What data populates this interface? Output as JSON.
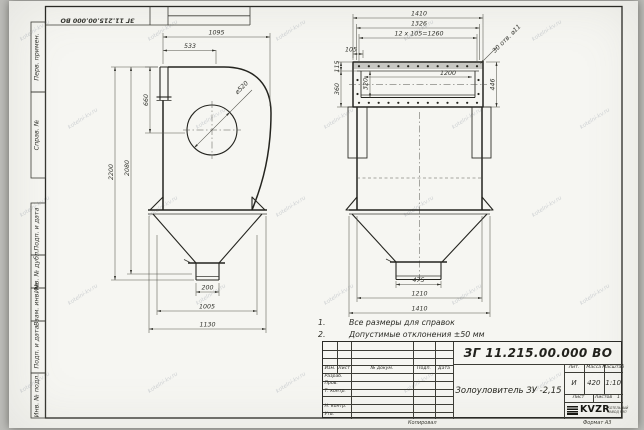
{
  "watermark": "kotelni-kv.ru",
  "frame": {
    "corner_number": "ЗГ 11.215.00.000 ВО",
    "side_labels": [
      "Перв. примен.",
      "Справ. №",
      "Подп. и дата",
      "Инв. № дубл.",
      "Взам. инв. №",
      "Подп. и дата",
      "Инв. № подл."
    ]
  },
  "notes": {
    "n1_num": "1.",
    "n1": "Все размеры для справок",
    "n2_num": "2.",
    "n2": "Допустимые отклонения  ±50 мм"
  },
  "dims": {
    "side_1095": "1095",
    "side_533": "533",
    "side_660": "660",
    "side_2200": "2200",
    "side_2080": "2080",
    "side_d520": "⌀520",
    "side_200": "200",
    "side_1005": "1005",
    "side_1130": "1130",
    "front_1410_top": "1410",
    "front_1326": "1326",
    "front_12x105": "12 х 105=1260",
    "front_105": "105",
    "front_holes": "30 отв. ⌀11",
    "front_1200": "1200",
    "front_115": "115",
    "front_360": "360",
    "front_320": "320",
    "front_446": "446",
    "front_475": "475",
    "front_1210": "1210",
    "front_1410_bot": "1410"
  },
  "title_block": {
    "doc_number": "ЗГ 11.215.00.000  ВО",
    "product_name": "Золоуловитель ЗУ -2,15",
    "col_izm": "Изм.",
    "col_list": "Лист",
    "col_doc": "№ докум.",
    "col_podp": "Подп.",
    "col_data": "Дата",
    "row_razrab": "Разраб.",
    "row_prov": "Пров.",
    "row_tkontr": "Т. контр.",
    "row_nkontr": "Н. контр.",
    "row_utv": "Утв.",
    "lit_label": "Лит.",
    "mass_label": "Масса",
    "scale_label": "Масштаб",
    "lit_value": "И",
    "mass_value": "420",
    "scale_value": "1:10",
    "sheet_label": "Лист",
    "sheets_label": "Листов",
    "sheets_value": "1",
    "logo_text": "KVZR",
    "logo_sub1": "КОТЕЛЬНЫЙ",
    "logo_sub2": "ЗАВОД РЭП",
    "copied": "Копировал",
    "format": "Формат А3"
  }
}
